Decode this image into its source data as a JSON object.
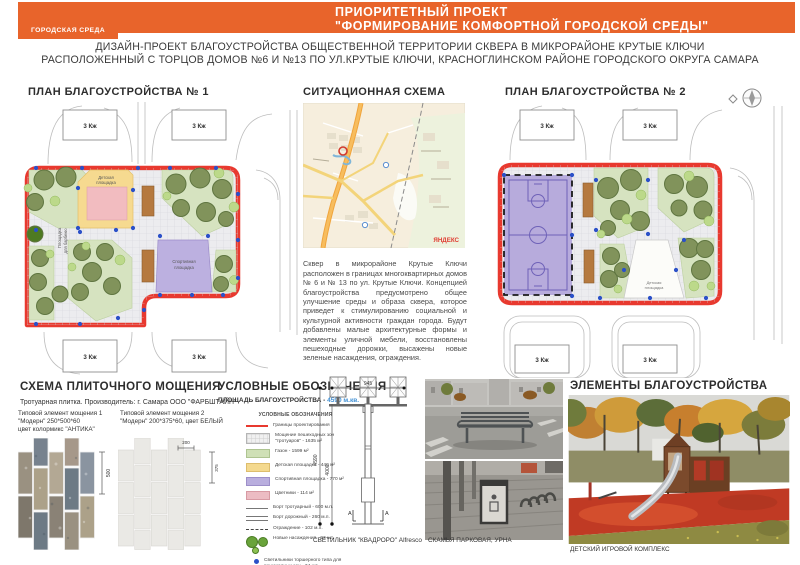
{
  "header": {
    "logo_text": "ГОРОДСКАЯ СРЕДА",
    "title_line1": "ПРИОРИТЕТНЫЙ ПРОЕКТ",
    "title_line2": "\"ФОРМИРОВАНИЕ  КОМФОРТНОЙ   ГОРОДСКОЙ  СРЕДЫ\"",
    "accent_color": "#e8642b"
  },
  "subtitle": {
    "line1": "ДИЗАЙН-ПРОЕКТ БЛАГОУСТРОЙСТВА ОБЩЕСТВЕННОЙ ТЕРРИТОРИИ СКВЕРА В МИКРОРАЙОНЕ КРУТЫЕ КЛЮЧИ",
    "line2": "РАСПОЛОЖЕННЫЙ С ТОРЦОВ ДОМОВ №6 И №13 ПО УЛ.КРУТЫЕ КЛЮЧИ, КРАСНОГЛИНСКОМ РАЙОНЕ ГОРОДСКОГО ОКРУГА САМАРА"
  },
  "plan1": {
    "title": "ПЛАН БЛАГОУСТРОЙСТВА  № 1",
    "building_label": "3 Кж",
    "labels": {
      "playground_line1": "Детская",
      "playground_line2": "площадка",
      "sport_line1": "Спортивная",
      "sport_line2": "площадка",
      "bbq_line1": "Площадка",
      "bbq_line2": "для барбекю"
    }
  },
  "situation": {
    "title": "СИТУАЦИОННАЯ СХЕМА",
    "map_watermark": "ЯНДЕКС",
    "description": "Сквер в микрорайоне Крутые Ключи расположен в границах многоквартирных домов № 6 и № 13 по ул. Крутые Ключи. Концепцией благоустройства предусмотрено общее улучшение среды и образа сквера, которое приведет к стимулированию социальной и культурной активности граждан города. Будут добавлены малые архитектурные формы и элементы уличной мебели, восстановлены пешеходные дорожки, высажены новые зеленые насаждения, ограждения."
  },
  "plan2": {
    "title": "ПЛАН БЛАГОУСТРОЙСТВА  № 2",
    "building_label": "3 Кж",
    "labels": {
      "playground_line1": "Детская",
      "playground_line2": "площадка"
    }
  },
  "paving": {
    "title": "СХЕМА ПЛИТОЧНОГО МОЩЕНИЯ",
    "subtitle": "Тротуарная плитка. Производитель: г. Самара ООО \"ФАРБШТАЙН\"",
    "tile1": {
      "caption_line1": "Типовой элемент мощения 1",
      "caption_line2": "\"Модерн\" 250*500*60",
      "caption_line3": "цвет колормикс \"АНТИКА\"",
      "dim_height": "500"
    },
    "tile2": {
      "caption_line1": "Типовой элемент мощения 2",
      "caption_line2": "\"Модерн\" 200*375*60, цвет  БЕЛЫЙ",
      "dim_width": "200",
      "dim_height": "375"
    }
  },
  "legend": {
    "title": "УСЛОВНЫЕ ОБОЗНАЧЕНИЯ",
    "area_label": "ПЛОЩАДЬ БЛАГОУСТРОЙСТВА -",
    "area_value": "4590 м.кв.",
    "inner_title": "УСЛОВНЫЕ ОБОЗНАЧЕНИЯ",
    "items": [
      {
        "swatch": "red-line",
        "label": "Границы проектирования"
      },
      {
        "swatch": "paving",
        "label": "Мощение пешеходных зон \"тротуаров\" - 1635 м²"
      },
      {
        "swatch": "green",
        "label": "Газон - 1599 м²"
      },
      {
        "swatch": "yellow",
        "label": "Детская площадка - 440 м²"
      },
      {
        "swatch": "purple",
        "label": "Спортивная площадка - 770 м²"
      },
      {
        "swatch": "pink",
        "label": "Цветники - 114 м²"
      },
      {
        "swatch": "line",
        "label": "Борт тротуарный - 600 м.п."
      },
      {
        "swatch": "double-line",
        "label": "Борт дорожный - 260 м.п."
      },
      {
        "swatch": "dash",
        "label": "Ограждение - 102 м.п."
      },
      {
        "swatch": "trees",
        "label": "Новые насаждения - 93 шт."
      },
      {
        "swatch": "dot",
        "label": "Светильники торшерного типа для пешеходных зон - 34 шт."
      },
      {
        "swatch": "none",
        "label": "Лавки - 20 шт.; Урны - 17 шт."
      }
    ]
  },
  "lamp": {
    "caption": "СВЕТИЛЬНИК \"КВАДРОРО\" Alfresco",
    "dims": {
      "width": "945",
      "height_total": "4590",
      "height_pole": "4000"
    },
    "section_mark": "А"
  },
  "bench": {
    "caption": "СКАМЬЯ ПАРКОВАЯ, УРНА"
  },
  "elements": {
    "title": "ЭЛЕМЕНТЫ  БЛАГОУСТРОЙСТВА",
    "photo_caption": "ДЕТСКИЙ ИГРОВОЙ КОМПЛЕКС"
  }
}
